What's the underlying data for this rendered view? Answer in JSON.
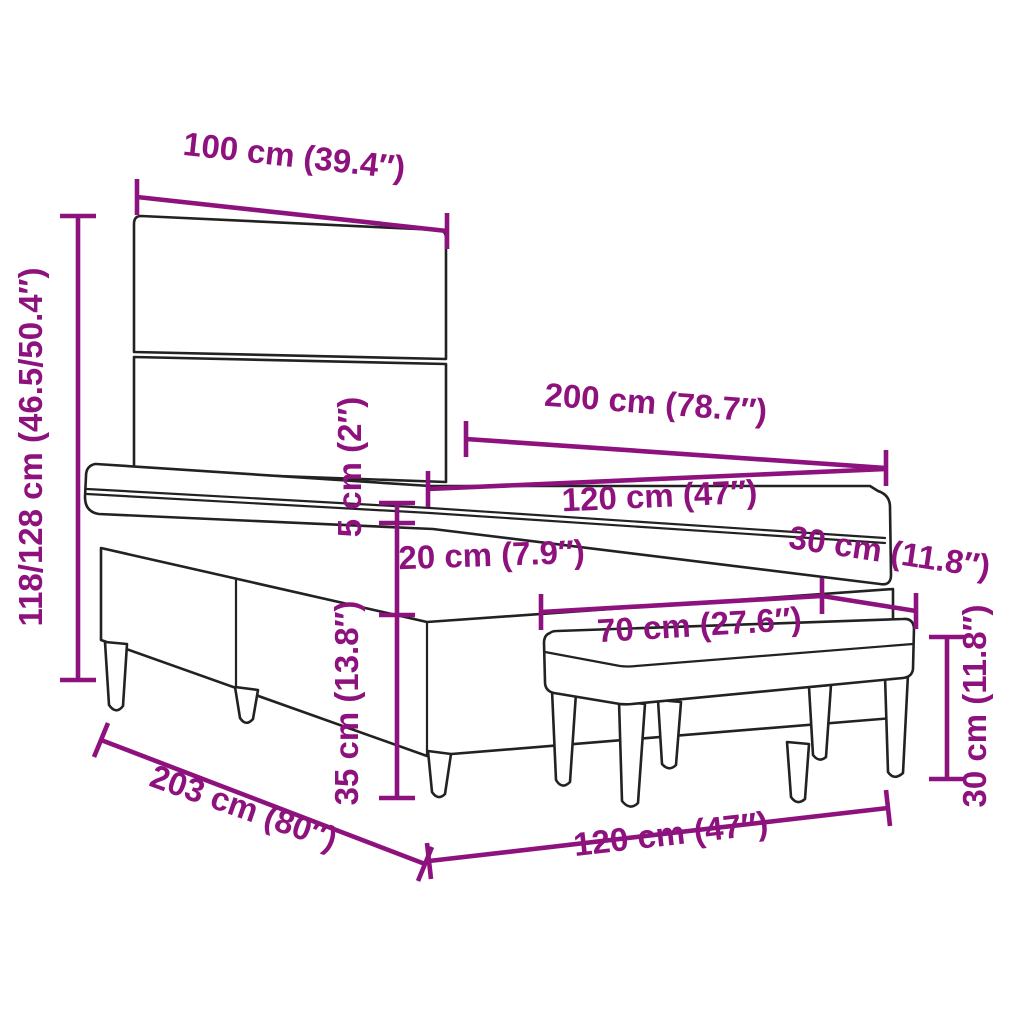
{
  "diagram": {
    "title": "Box spring bed with tufted headboard and bench – dimension diagram",
    "accent_color": "#8E127E",
    "line_color": "#222222",
    "dimensions": {
      "headboard_width": "100 cm (39.4″)",
      "overall_height": "118/128 cm (46.5/50.4″)",
      "bed_length": "200 cm (78.7″)",
      "mattress_width": "120 cm (47″)",
      "topper_thickness": "5 cm (2″)",
      "box_height": "20 cm (7.9″)",
      "bench_depth": "30 cm (11.8″)",
      "bench_length": "70 cm (27.6″)",
      "leg_height": "35 cm (13.8″)",
      "bench_height": "30 cm (11.8″)",
      "frame_length": "203 cm (80″)",
      "frame_width": "120 cm (47″)"
    }
  }
}
